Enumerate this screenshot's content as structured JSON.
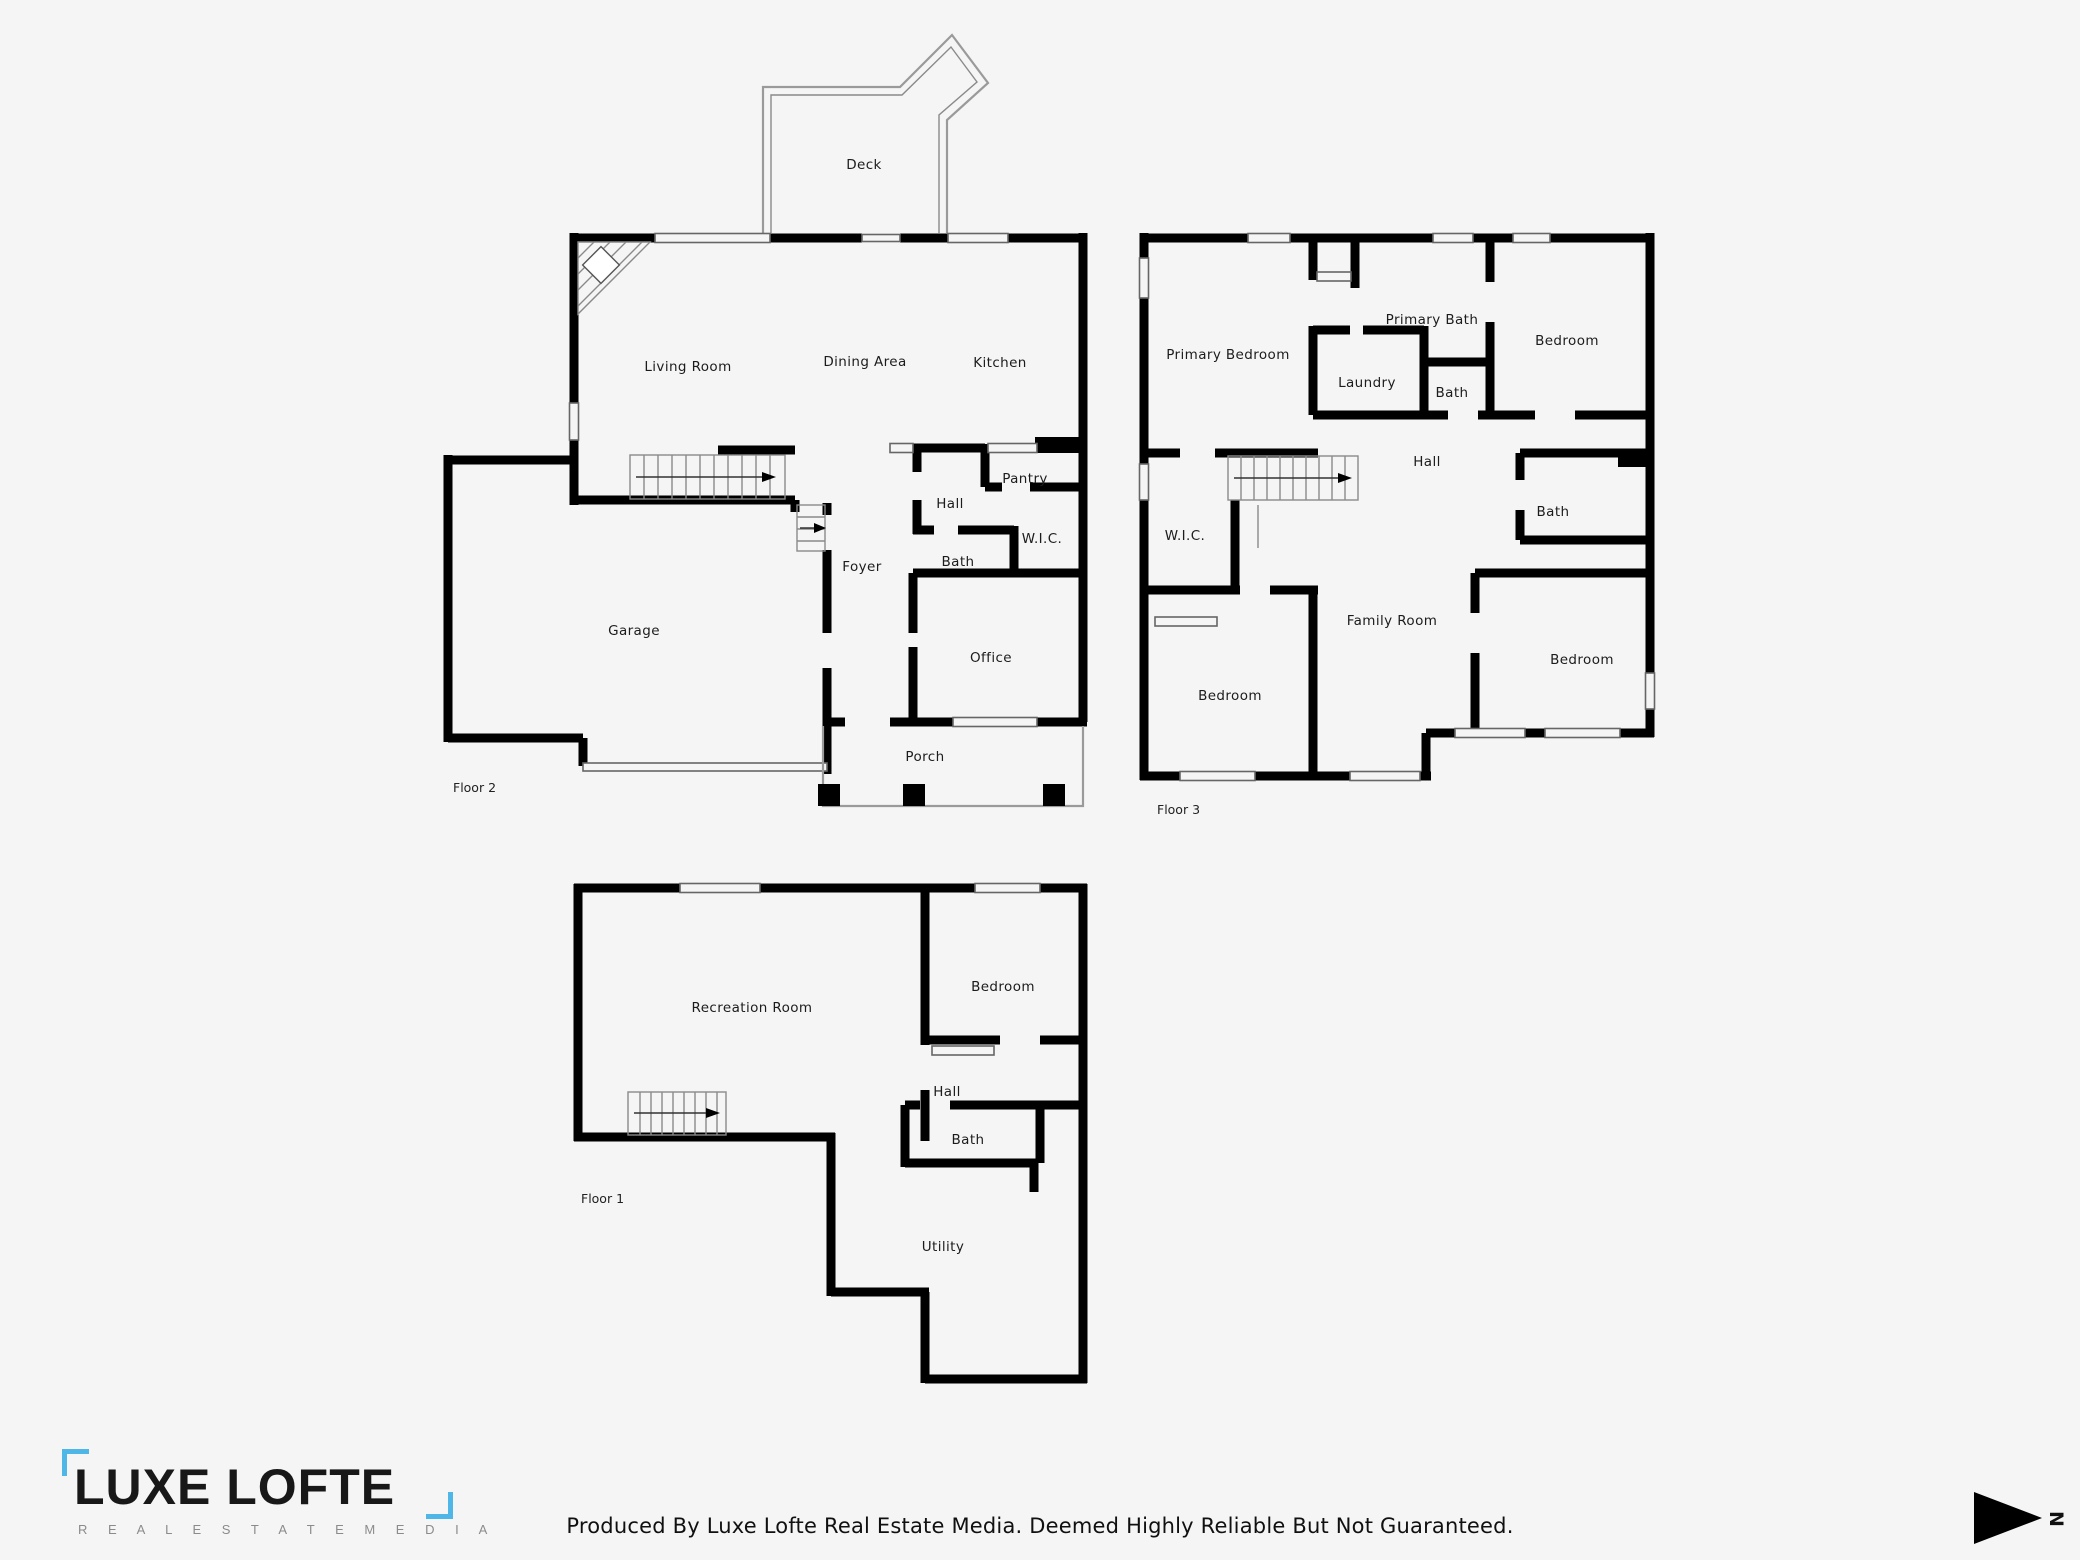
{
  "floor2": {
    "label": "Floor 2",
    "rooms": {
      "deck": "Deck",
      "living": "Living Room",
      "dining": "Dining Area",
      "kitchen": "Kitchen",
      "pantry": "Pantry",
      "hall": "Hall",
      "wic": "W.I.C.",
      "bath": "Bath",
      "foyer": "Foyer",
      "office": "Office",
      "garage": "Garage",
      "porch": "Porch"
    }
  },
  "floor3": {
    "label": "Floor 3",
    "rooms": {
      "primary_bedroom": "Primary Bedroom",
      "primary_bath": "Primary Bath",
      "laundry": "Laundry",
      "bath_top": "Bath",
      "bedroom_top_right": "Bedroom",
      "hall": "Hall",
      "wic": "W.I.C.",
      "bath_mid": "Bath",
      "family_room": "Family Room",
      "bedroom_bottom_left": "Bedroom",
      "bedroom_bottom_right": "Bedroom"
    }
  },
  "floor1": {
    "label": "Floor 1",
    "rooms": {
      "recreation": "Recreation Room",
      "bedroom": "Bedroom",
      "hall": "Hall",
      "bath": "Bath",
      "utility": "Utility"
    }
  },
  "branding": {
    "logo_main": "LUXE LOFTE",
    "logo_sub": "R E A L   E S T A T E   M E D I A",
    "accent_color": "#4fb6e8"
  },
  "footer": {
    "disclaimer": "Produced By Luxe Lofte Real Estate Media. Deemed Highly Reliable But Not Guaranteed."
  },
  "compass": {
    "letter": "N"
  }
}
